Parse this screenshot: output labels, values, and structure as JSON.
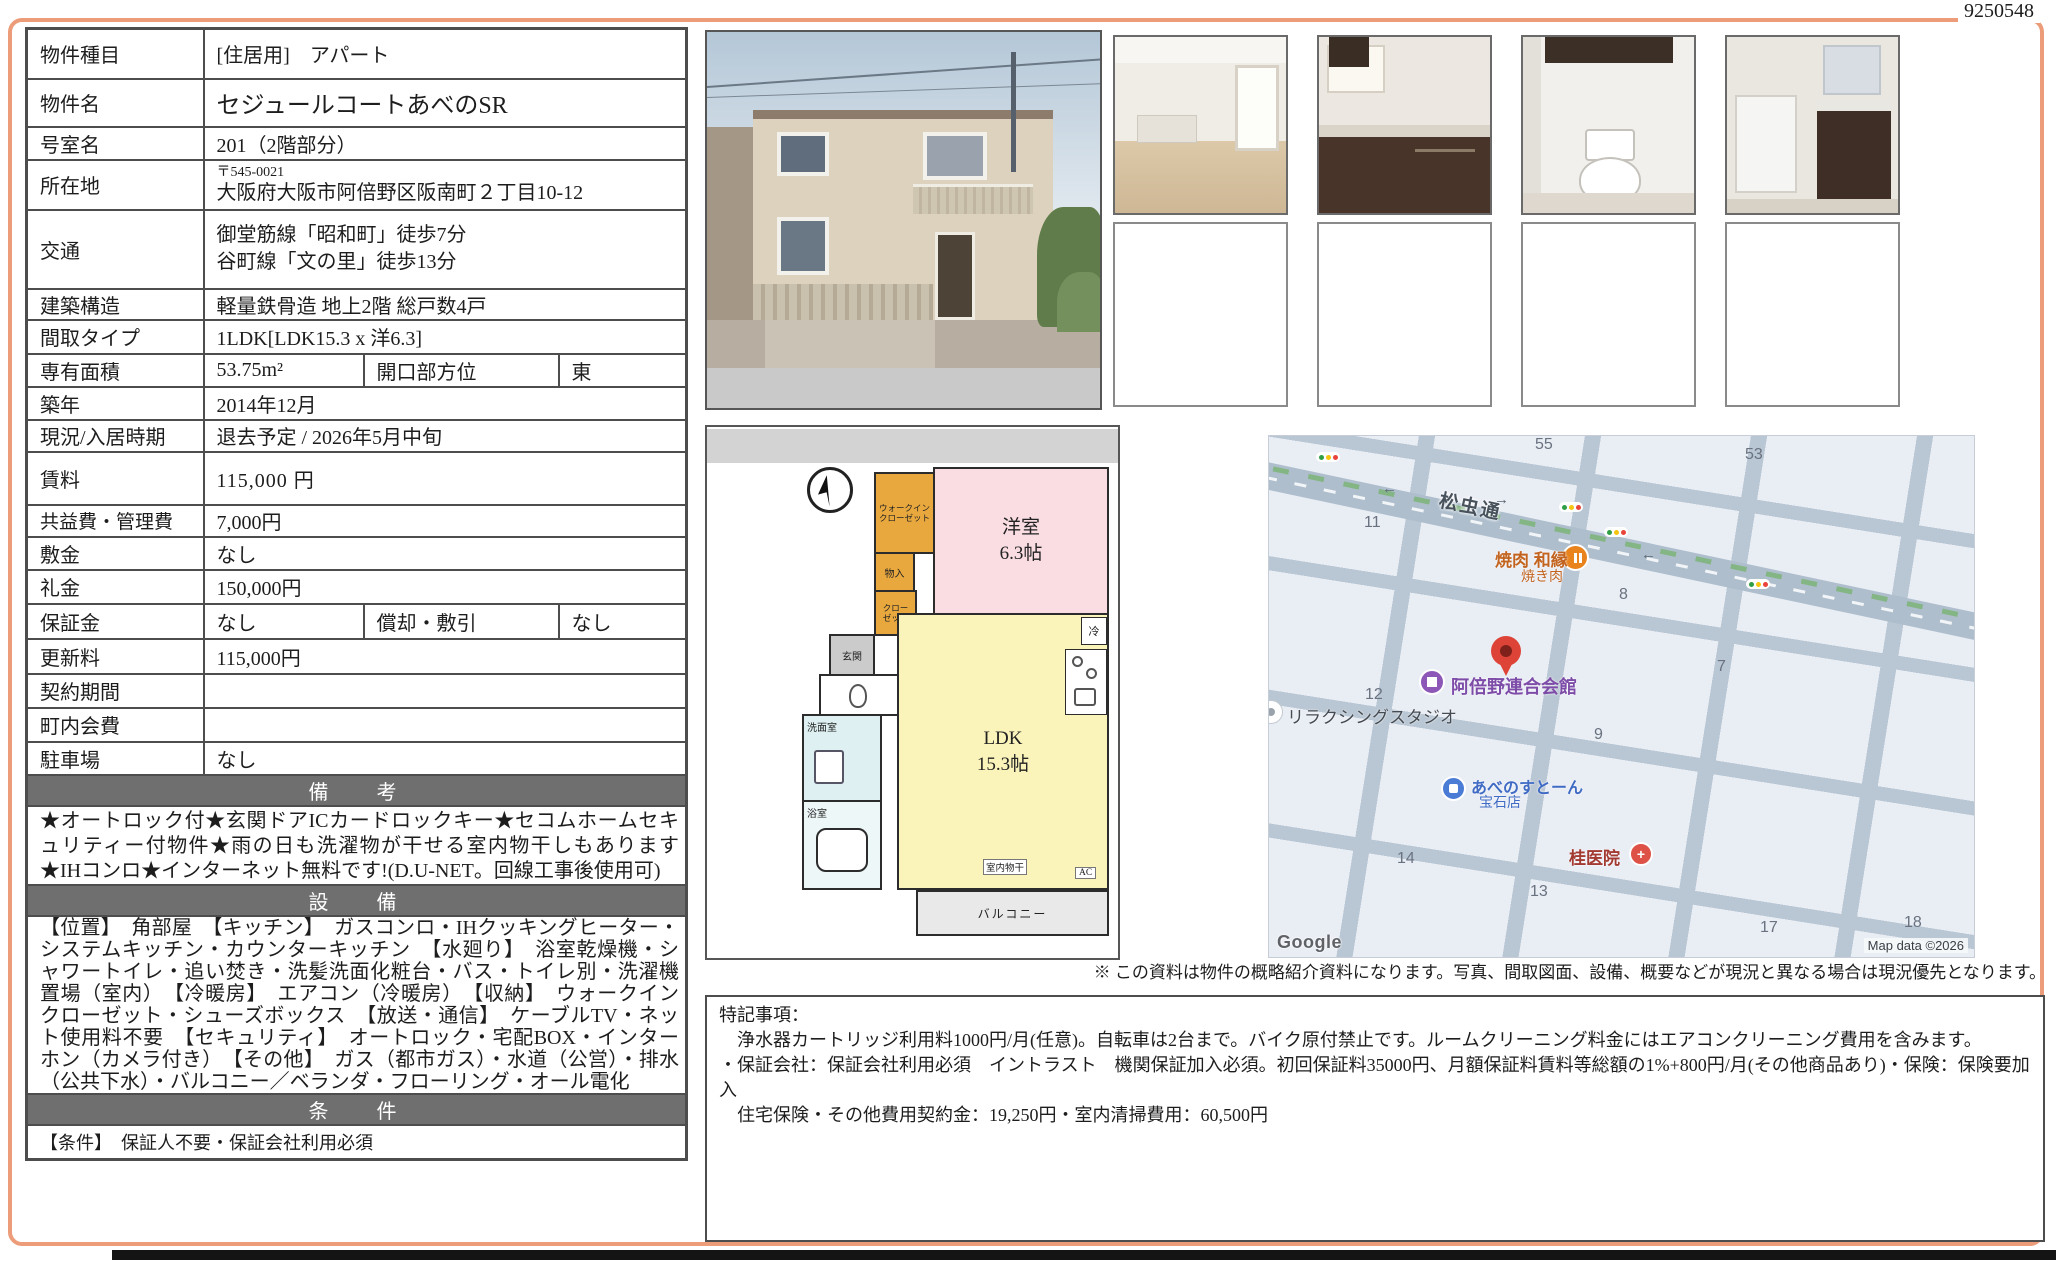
{
  "doc_number": "9250548",
  "table": {
    "rows": [
      {
        "l": "物件種目",
        "v": "[住居用]　アパート"
      },
      {
        "l": "物件名",
        "v": "セジュールコートあべのSR"
      },
      {
        "l": "号室名",
        "v": "201（2階部分）"
      },
      {
        "l": "所在地",
        "postal": "〒545-0021",
        "v": "大阪府大阪市阿倍野区阪南町２丁目10-12"
      },
      {
        "l": "交通",
        "v1": "御堂筋線「昭和町」徒歩7分",
        "v2": "谷町線「文の里」徒歩13分"
      },
      {
        "l": "建築構造",
        "v": "軽量鉄骨造 地上2階 総戸数4戸"
      },
      {
        "l": "間取タイプ",
        "v": "1LDK[LDK15.3 x 洋6.3]"
      },
      {
        "l": "専有面積",
        "v": "53.75m²",
        "l2": "開口部方位",
        "v2": "東"
      },
      {
        "l": "築年",
        "v": "2014年12月"
      },
      {
        "l": "現況/入居時期",
        "v": "退去予定 / 2026年5月中旬"
      },
      {
        "l": "賃料",
        "v": "115,000 円"
      },
      {
        "l": "共益費・管理費",
        "v": "7,000円"
      },
      {
        "l": "敷金",
        "v": "なし"
      },
      {
        "l": "礼金",
        "v": "150,000円"
      },
      {
        "l": "保証金",
        "v": "なし",
        "l2": "償却・敷引",
        "v2": "なし"
      },
      {
        "l": "更新料",
        "v": "115,000円"
      },
      {
        "l": "契約期間",
        "v": ""
      },
      {
        "l": "町内会費",
        "v": ""
      },
      {
        "l": "駐車場",
        "v": "なし"
      }
    ],
    "biko_title": "備　考",
    "biko_text": "★オートロック付★玄関ドアICカードロックキー★セコムホームセキュリティー付物件★雨の日も洗濯物が干せる室内物干しもあります★IHコンロ★インターネット無料です!(D.U-NET。回線工事後使用可)",
    "setsubi_title": "設　備",
    "setsubi_text": "【位置】　角部屋　【キッチン】　ガスコンロ・IHクッキングヒーター・システムキッチン・カウンターキッチン　【水廻り】　浴室乾燥機・シャワートイレ・追い焚き・洗髪洗面化粧台・バス・トイレ別・洗濯機置場（室内）　【冷暖房】　エアコン（冷暖房）　【収納】　ウォークインクローゼット・シューズボックス　【放送・通信】　ケーブルTV・ネット使用料不要　【セキュリティ】　オートロック・宅配BOX・インターホン（カメラ付き）　【その他】　ガス（都市ガス）・水道（公営）・排水（公共下水）・バルコニー／ベランダ・フローリング・オール電化",
    "joken_title": "条　件",
    "joken_text": "【条件】　保証人不要・保証会社利用必須"
  },
  "floorplan": {
    "wic": "ウォークイン\nクローゼット",
    "monoire": "物入",
    "closet": "クロー\nゼット",
    "genkan": "玄関",
    "senmen": "洗面室",
    "bath": "浴室",
    "western": "洋室\n6.3帖",
    "ldk": "LDK\n15.3帖",
    "rei": "冷",
    "ac": "AC",
    "monohoshi": "室内物干",
    "balcony": "バルコニー"
  },
  "map": {
    "road": "松虫通",
    "numbers": {
      "n55": "55",
      "n53": "53",
      "n11": "11",
      "n8": "8",
      "n7": "7",
      "n12": "12",
      "n9": "9",
      "n14": "14",
      "n13": "13",
      "n17": "17",
      "n18": "18"
    },
    "yakiniku1": "焼肉 和縁",
    "yakiniku2": "焼き肉",
    "kaikan": "阿倍野連合会館",
    "studio": "リラクシングスタジオ",
    "stone1": "あべのすとーん",
    "stone2": "宝石店",
    "clinic": "桂医院",
    "google": "Google",
    "attribution": "Map data ©2026",
    "arrow_left": "←",
    "arrow_right": "→"
  },
  "note": "※ この資料は物件の概略紹介資料になります。写真、間取図面、設備、概要などが現況と異なる場合は現況優先となります。",
  "tokki": {
    "title": "特記事項：",
    "line1": "　浄水器カートリッジ利用料1000円/月(任意)。自転車は2台まで。バイク原付禁止です。ルームクリーニング料金にはエアコンクリーニング費用を含みます。",
    "line2": "・保証会社：保証会社利用必須　イントラスト　機関保証加入必須。初回保証料35000円、月額保証料賃料等総額の1%+800円/月(その他商品あり)・保険：保険要加入",
    "line3": "　住宅保険・その他費用契約金：19,250円・室内清掃費用：60,500円"
  }
}
